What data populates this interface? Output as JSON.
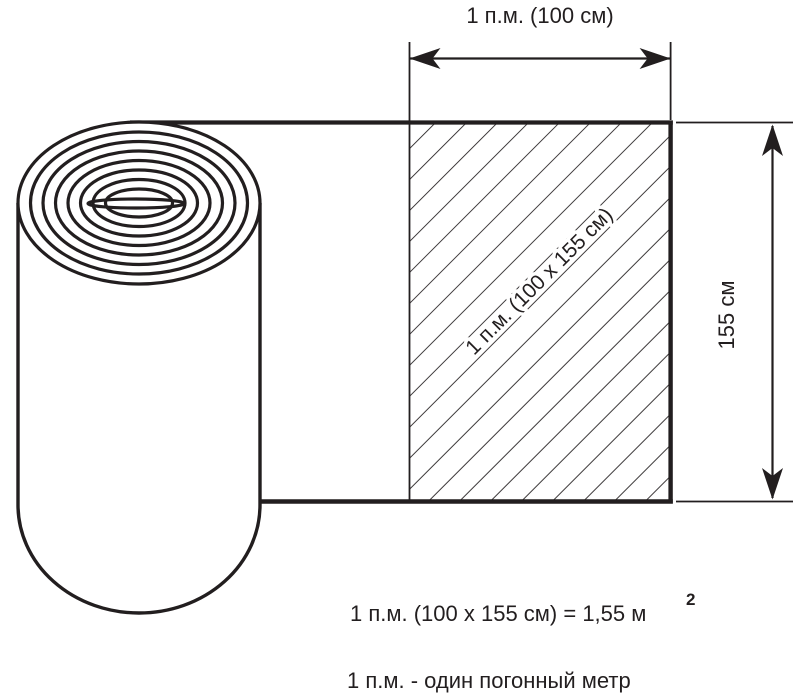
{
  "colors": {
    "ink": "#221e1f",
    "paper": "#ffffff"
  },
  "top_dimension": {
    "label": "1 п.м. (100 см)"
  },
  "side_dimension": {
    "label": "155 см"
  },
  "hatch_area": {
    "label": "1 п.м. (100 х 155 см)"
  },
  "legend": {
    "equation": "1 п.м. (100 х 155 см) = 1,55 м",
    "equation_superscript": "2",
    "definition": "1 п.м. - один погонный метр"
  }
}
